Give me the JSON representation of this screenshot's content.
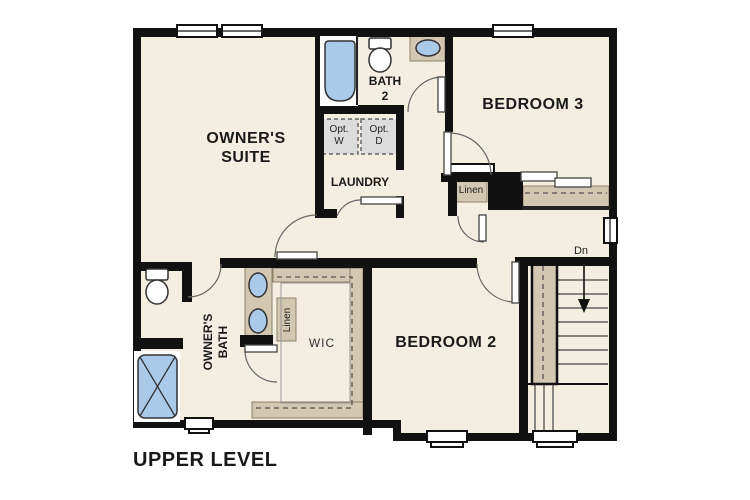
{
  "title": "UPPER LEVEL",
  "rooms": {
    "owners_suite": {
      "l1": "OWNER'S",
      "l2": "SUITE"
    },
    "bedroom3": "BEDROOM 3",
    "bedroom2": "BEDROOM 2",
    "laundry": "LAUNDRY",
    "bath2": {
      "l1": "BATH",
      "l2": "2"
    },
    "owners_bath": {
      "l1": "OWNER'S",
      "l2": "BATH"
    },
    "wic": "WIC"
  },
  "closets": {
    "linen_hall": "Linen",
    "linen_bath": "Linen"
  },
  "appliances": {
    "washer": {
      "l1": "Opt.",
      "l2": "W"
    },
    "dryer": {
      "l1": "Opt.",
      "l2": "D"
    }
  },
  "stairs": {
    "down_label": "Dn"
  },
  "colors": {
    "wall": "#111111",
    "floor": "#f4eee0",
    "shelf_tan": "#d2c7b0",
    "fixture_blue": "#abc9e8",
    "appliance_gray": "#dcdcdc"
  }
}
